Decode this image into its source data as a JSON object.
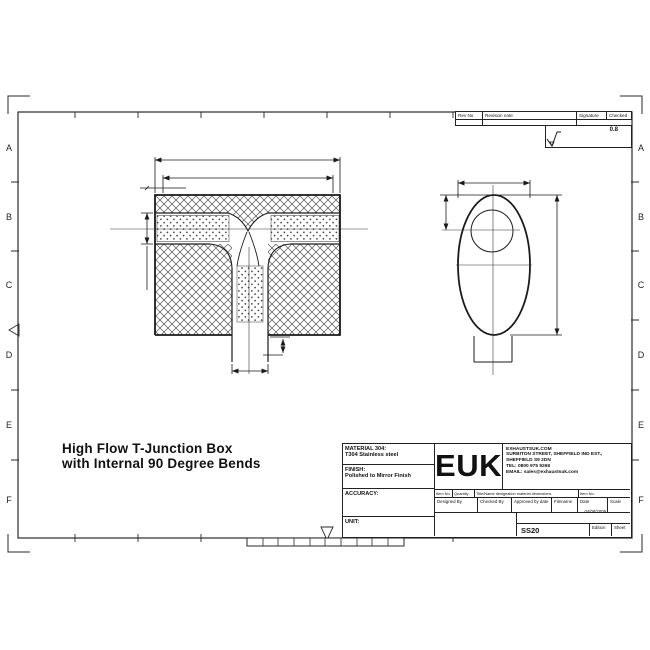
{
  "drawing_title": {
    "line1": "High Flow T-Junction Box",
    "line2": "with Internal 90 Degree Bends"
  },
  "frame": {
    "row_labels": [
      "A",
      "B",
      "C",
      "D",
      "E",
      "F"
    ]
  },
  "revision_table": {
    "rev_no": "Rev No",
    "revision_note": "Revision note",
    "signature": "Signature",
    "checked": "Checked",
    "surface_finish": "0.8"
  },
  "title_block": {
    "material_label": "MATERIAL 304:",
    "material_value": "T304 Stainless steel",
    "finish_label": "FINISH:",
    "finish_value": "Polished to Mirror Finish",
    "accuracy_label": "ACCURACY:",
    "unit_label": "UNIT:",
    "logo": "EUK",
    "company": {
      "line1": "EXHAUSTSUK.COM",
      "line2": "SURBITON STREET, SHEFFIELD IND EST.,",
      "line3": "SHEFFIELD S9 2DN",
      "line4": "TEL: 0800 975 9268",
      "line5": "EMAIL: sales@exhaustsuk.com"
    },
    "parts_header": {
      "item_no": "Item No",
      "quantity": "Quantity",
      "title_name": "Title/Name designation material dimensions",
      "item_no2": "Item No."
    },
    "approval_row": {
      "designed_by": "Designed By",
      "checked_by": "Checked By",
      "approved_by": "Approved by date",
      "filename": "Filename",
      "date_label": "Date",
      "date_value": "04/06/2009",
      "scale_label": "Scale"
    },
    "drawing_number": "SS20",
    "edition_label": "Edition",
    "sheet_label": "Sheet"
  },
  "colors": {
    "line": "#1a1a1a",
    "background": "#ffffff"
  }
}
